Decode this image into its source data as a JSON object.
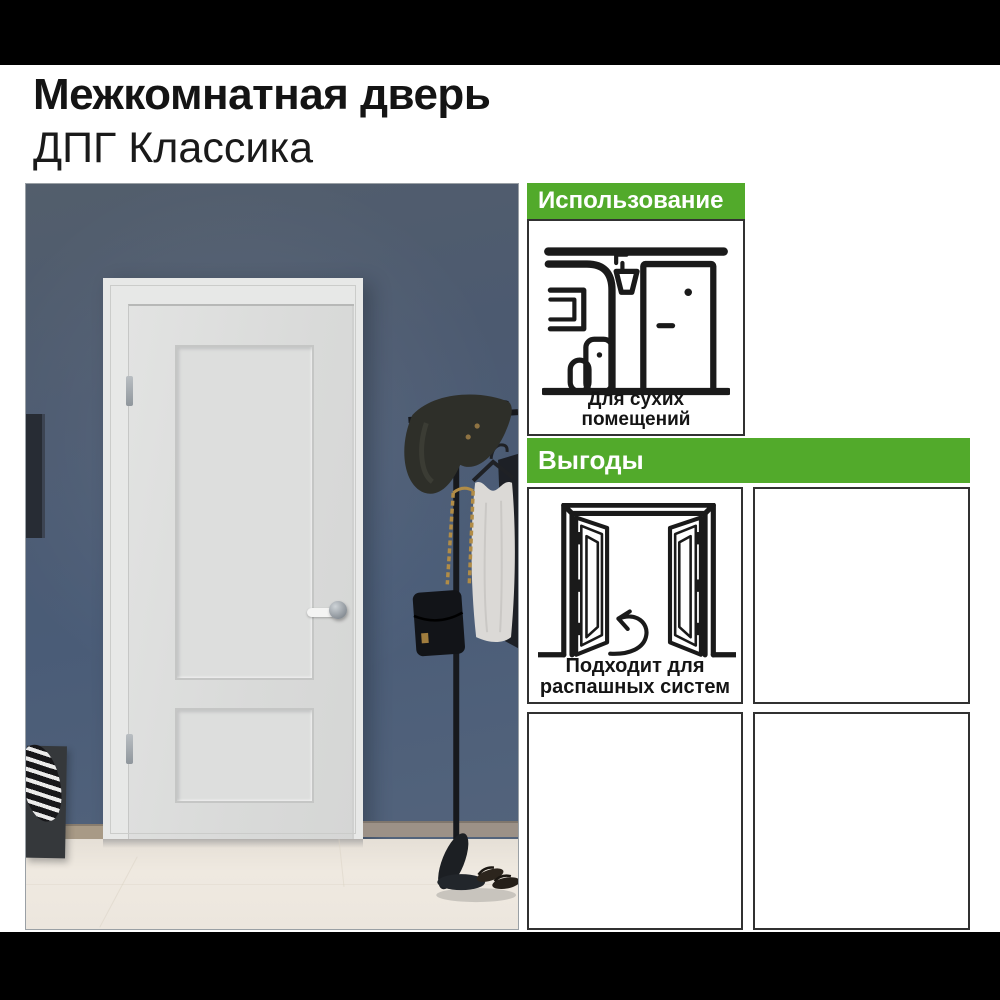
{
  "header": {
    "title_line1": "Межкомнатная дверь",
    "title_line2": "ДПГ Классика"
  },
  "panels": {
    "usage": {
      "header": "Использование",
      "icon": "dry-room-icon",
      "caption_line1": "Для сухих",
      "caption_line2": "помещений"
    },
    "benefits": {
      "header": "Выгоды",
      "boxes": [
        {
          "icon": "swing-doors-icon",
          "caption_line1": "Подходит для",
          "caption_line2": "распашных систем"
        },
        {
          "icon": "",
          "caption_line1": "",
          "caption_line2": ""
        },
        {
          "icon": "",
          "caption_line1": "",
          "caption_line2": ""
        },
        {
          "icon": "",
          "caption_line1": "",
          "caption_line2": ""
        }
      ]
    }
  },
  "photo": {
    "scene_elements": [
      "white-interior-door",
      "door-frame",
      "blue-gray-wall",
      "picture-frame-edge",
      "coat-rack-stand",
      "floppy-hat",
      "white-tank-top",
      "black-garment",
      "gold-chain-bag",
      "laundry-basket-striped-cloth",
      "sandals",
      "tiled-floor",
      "baseboard"
    ]
  },
  "colors": {
    "accent_green": "#52aa2b",
    "letterbox_black": "#000000",
    "wall_blue": "#4c5c75",
    "door_white": "#dcdddc",
    "floor_cream": "#ece6de",
    "icon_stroke": "#1a1a1a",
    "chain_gold": "#b18c46",
    "box_border": "#313131"
  }
}
